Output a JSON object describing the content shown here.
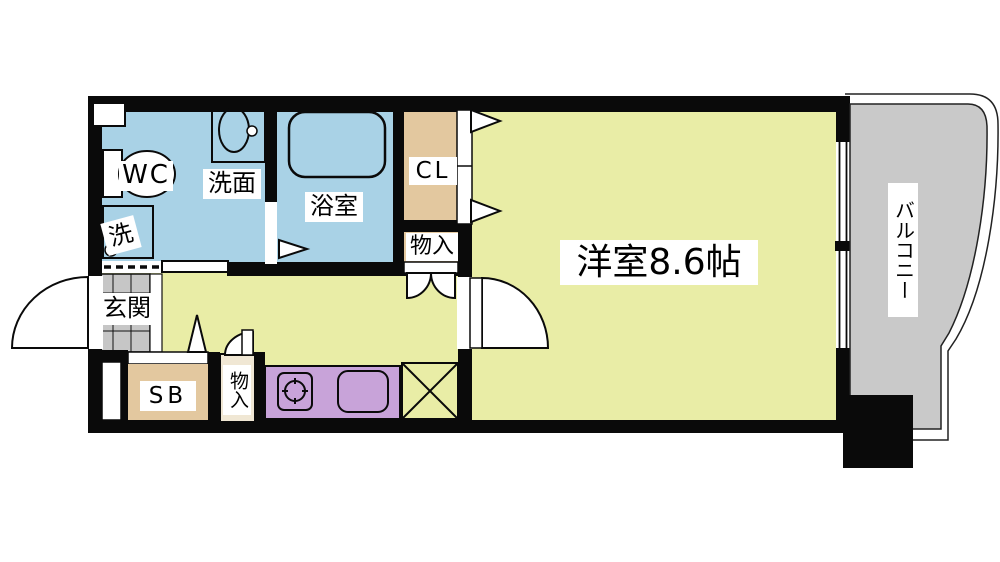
{
  "plan_title": "1K apartment floor plan",
  "labels": {
    "wc": "WC",
    "washbasin": "洗面",
    "washer": "洗",
    "bathroom": "浴室",
    "closet": "CL",
    "storage_upper": "物入",
    "western_room": "洋室8.6帖",
    "balcony": "バルコニー",
    "entrance": "玄関",
    "shoe_box": "SB",
    "storage_lower": "物入"
  },
  "colors": {
    "floor_yellow": "#e9eda6",
    "water_blue": "#a9d2e6",
    "closet_tan": "#e3c89f",
    "kitchen_purple": "#c8a3d9",
    "balcony_gray": "#c9c9c9",
    "tile_gray": "#c6c6c6",
    "storage_cream": "#f0e7d4",
    "wall_black": "#0a0a0a"
  }
}
